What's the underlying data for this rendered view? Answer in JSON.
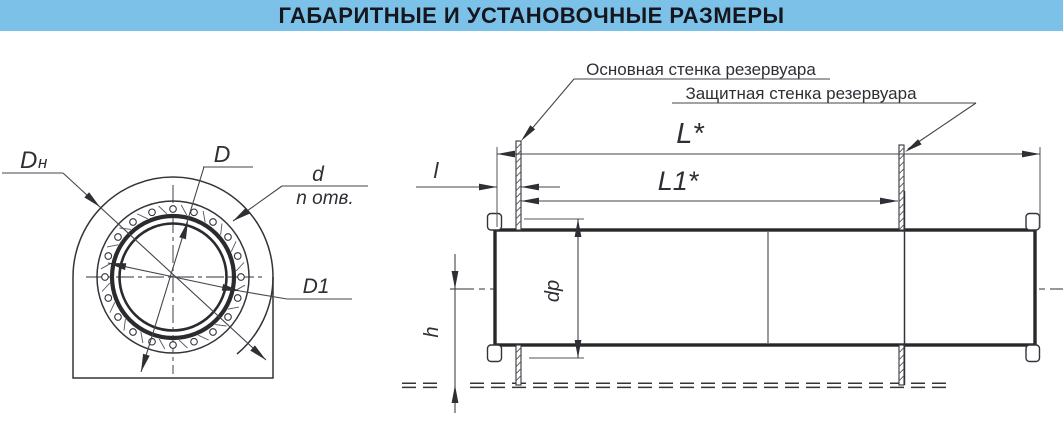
{
  "header": {
    "title": "ГАБАРИТНЫЕ И УСТАНОВОЧНЫЕ РАЗМЕРЫ"
  },
  "colors": {
    "header_bg": "#7cc2e8",
    "header_text": "#16161e",
    "line": "#33343a"
  },
  "front_view": {
    "label_outer_dia_base": "D",
    "label_outer_dia_sub": "н",
    "label_flange_dia": "D",
    "label_hole_dia": "d",
    "label_hole_count": "n отв.",
    "label_bolt_circle_dia": "D1"
  },
  "side_view": {
    "label_main_wall": "Основная стенка резервуара",
    "label_protective_wall": "Защитная стенка резервуара",
    "label_length_total": "L*",
    "label_length_between_walls": "L1*",
    "label_protrusion": "l",
    "label_pipe_dia": "dp",
    "label_height": "h"
  }
}
